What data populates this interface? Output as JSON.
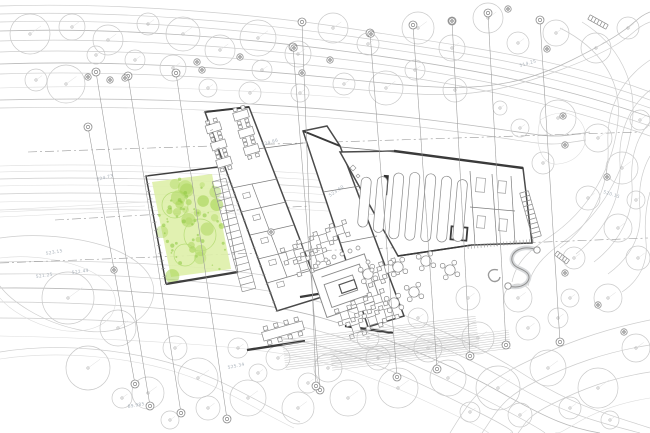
{
  "colors": {
    "background": "#ffffff",
    "contour": "#cdcdcd",
    "wall_dark": "#3f3f3f",
    "wall_medium": "#7d7d7d",
    "grid": "#989898",
    "tree": "#c9c9c9",
    "green_fill": "#def0a9",
    "green_blob": "#a3d24f",
    "label": "#9aa4ae",
    "furniture": "#8a8a8a"
  },
  "annotations": {
    "elevation_labels": [
      {
        "text": "524.73",
        "x": 97,
        "y": 181,
        "rot": -14
      },
      {
        "text": "523.15",
        "x": 46,
        "y": 255,
        "rot": -10
      },
      {
        "text": "521.25",
        "x": 36,
        "y": 278,
        "rot": -8
      },
      {
        "text": "522.49",
        "x": 72,
        "y": 274,
        "rot": -8
      },
      {
        "text": "525.34",
        "x": 228,
        "y": 369,
        "rot": -12
      },
      {
        "text": "89.985",
        "x": 128,
        "y": 408,
        "rot": -10
      },
      {
        "text": "524.86",
        "x": 262,
        "y": 146,
        "rot": -16
      },
      {
        "text": "523.60",
        "x": 330,
        "y": 197,
        "rot": -34
      },
      {
        "text": "514.25",
        "x": 520,
        "y": 67,
        "rot": -16
      },
      {
        "text": "520.15",
        "x": 603,
        "y": 193,
        "rot": 18
      }
    ]
  },
  "site": {
    "trees": [
      [
        30,
        34,
        20
      ],
      [
        72,
        27,
        13
      ],
      [
        108,
        40,
        15
      ],
      [
        66,
        84,
        19
      ],
      [
        36,
        80,
        11
      ],
      [
        148,
        24,
        11
      ],
      [
        183,
        34,
        17
      ],
      [
        173,
        68,
        13
      ],
      [
        220,
        50,
        15
      ],
      [
        258,
        38,
        18
      ],
      [
        298,
        54,
        13
      ],
      [
        333,
        28,
        15
      ],
      [
        368,
        44,
        11
      ],
      [
        418,
        28,
        16
      ],
      [
        452,
        48,
        13
      ],
      [
        488,
        18,
        15
      ],
      [
        518,
        43,
        11
      ],
      [
        556,
        33,
        13
      ],
      [
        596,
        48,
        15
      ],
      [
        628,
        28,
        11
      ],
      [
        250,
        93,
        11
      ],
      [
        208,
        88,
        9
      ],
      [
        300,
        93,
        9
      ],
      [
        344,
        84,
        11
      ],
      [
        386,
        88,
        17
      ],
      [
        415,
        70,
        10
      ],
      [
        455,
        90,
        12
      ],
      [
        262,
        70,
        10
      ],
      [
        135,
        60,
        10
      ],
      [
        96,
        55,
        9
      ],
      [
        558,
        118,
        18
      ],
      [
        598,
        138,
        14
      ],
      [
        622,
        168,
        16
      ],
      [
        588,
        198,
        12
      ],
      [
        618,
        228,
        14
      ],
      [
        574,
        258,
        11
      ],
      [
        638,
        258,
        12
      ],
      [
        608,
        298,
        14
      ],
      [
        570,
        298,
        9
      ],
      [
        520,
        128,
        9
      ],
      [
        543,
        163,
        11
      ],
      [
        500,
        108,
        7
      ],
      [
        640,
        120,
        10
      ],
      [
        636,
        200,
        9
      ],
      [
        68,
        298,
        26
      ],
      [
        118,
        328,
        18
      ],
      [
        88,
        368,
        22
      ],
      [
        148,
        393,
        16
      ],
      [
        198,
        378,
        20
      ],
      [
        248,
        398,
        18
      ],
      [
        298,
        408,
        16
      ],
      [
        348,
        398,
        18
      ],
      [
        398,
        388,
        20
      ],
      [
        448,
        378,
        18
      ],
      [
        498,
        388,
        22
      ],
      [
        548,
        368,
        18
      ],
      [
        598,
        388,
        20
      ],
      [
        636,
        348,
        14
      ],
      [
        278,
        358,
        12
      ],
      [
        328,
        368,
        14
      ],
      [
        378,
        358,
        12
      ],
      [
        428,
        348,
        14
      ],
      [
        478,
        338,
        16
      ],
      [
        528,
        328,
        12
      ],
      [
        238,
        348,
        10
      ],
      [
        175,
        348,
        12
      ],
      [
        518,
        298,
        14
      ],
      [
        558,
        318,
        10
      ],
      [
        468,
        298,
        12
      ],
      [
        418,
        318,
        10
      ],
      [
        368,
        338,
        11
      ],
      [
        308,
        383,
        10
      ],
      [
        258,
        373,
        9
      ],
      [
        208,
        408,
        12
      ],
      [
        122,
        398,
        10
      ],
      [
        170,
        420,
        9
      ],
      [
        520,
        415,
        12
      ],
      [
        470,
        412,
        10
      ],
      [
        570,
        408,
        11
      ],
      [
        610,
        420,
        9
      ]
    ],
    "tree_tags": [
      [
        88,
        77
      ],
      [
        110,
        80
      ],
      [
        125,
        78
      ],
      [
        197,
        62
      ],
      [
        202,
        70
      ],
      [
        294,
        48
      ],
      [
        302,
        73
      ],
      [
        371,
        34
      ],
      [
        452,
        21
      ],
      [
        508,
        9
      ],
      [
        547,
        49
      ],
      [
        563,
        116
      ],
      [
        565,
        145
      ],
      [
        607,
        177
      ],
      [
        271,
        232
      ],
      [
        114,
        270
      ],
      [
        565,
        273
      ],
      [
        598,
        305
      ],
      [
        624,
        332
      ],
      [
        330,
        60
      ],
      [
        240,
        57
      ]
    ],
    "grid_lines": [
      [
        88,
        127,
        135,
        384
      ],
      [
        96,
        72,
        150,
        406
      ],
      [
        128,
        76,
        181,
        413
      ],
      [
        176,
        73,
        227,
        419
      ],
      [
        293,
        47,
        320,
        390
      ],
      [
        302,
        22,
        316,
        386
      ],
      [
        370,
        33,
        397,
        377
      ],
      [
        413,
        25,
        437,
        369
      ],
      [
        452,
        21,
        470,
        356
      ],
      [
        488,
        13,
        506,
        345
      ],
      [
        540,
        20,
        560,
        342
      ]
    ],
    "stairs": [
      {
        "x1": 219,
        "y1": 180,
        "x2": 249,
        "y2": 290,
        "w": 14,
        "n": 17
      },
      {
        "x1": 524,
        "y1": 192,
        "x2": 537,
        "y2": 237,
        "w": 9,
        "n": 10
      },
      {
        "x1": 589,
        "y1": 17,
        "x2": 607,
        "y2": 27,
        "w": 5,
        "n": 6
      },
      {
        "x1": 556,
        "y1": 253,
        "x2": 568,
        "y2": 262,
        "w": 5,
        "n": 5
      }
    ],
    "hatches": [
      {
        "x": 282,
        "y": 340,
        "rot": -7,
        "len": 195,
        "n": 14,
        "gap": 2.3
      },
      {
        "x": 330,
        "y": 352,
        "rot": -7,
        "len": 180,
        "n": 9,
        "gap": 2.3
      }
    ],
    "ticked_walls": [
      {
        "x1": 468,
        "y1": 247,
        "x2": 533,
        "y2": 241,
        "n": 20,
        "len": 4
      },
      {
        "x1": 146,
        "y1": 176,
        "x2": 166,
        "y2": 284,
        "n": 14,
        "len": 4
      },
      {
        "x1": 205,
        "y1": 112,
        "x2": 277,
        "y2": 311,
        "n": 22,
        "len": 3
      }
    ]
  },
  "green_area": {
    "poly": "152,182 212,174 231,269 171,277",
    "blob_count": 26,
    "dot_count": 42
  },
  "furniture": {
    "classroom_rot": -17,
    "classroom_center": [
      235,
      140
    ],
    "classroom_tables": [
      [
        218,
        122
      ],
      [
        218,
        140
      ],
      [
        218,
        158
      ],
      [
        248,
        118
      ],
      [
        248,
        136
      ],
      [
        248,
        154
      ]
    ],
    "long_tables": [
      [
        364,
        182,
        50
      ],
      [
        380,
        180,
        56
      ],
      [
        396,
        175,
        66
      ],
      [
        412,
        173,
        68
      ],
      [
        428,
        173,
        68
      ],
      [
        444,
        174,
        66
      ],
      [
        460,
        176,
        62
      ]
    ],
    "long_rot": 5,
    "long_center": [
      420,
      210
    ],
    "square_rot": -17,
    "square_center": [
      345,
      285
    ],
    "square_tables": [
      [
        302,
        240
      ],
      [
        320,
        237
      ],
      [
        338,
        234
      ],
      [
        356,
        231
      ],
      [
        311,
        255
      ],
      [
        329,
        252
      ],
      [
        336,
        314
      ],
      [
        354,
        311
      ],
      [
        372,
        308
      ],
      [
        343,
        330
      ],
      [
        361,
        327
      ],
      [
        379,
        324
      ],
      [
        376,
        286
      ],
      [
        392,
        282
      ]
    ],
    "round_tables": [
      [
        368,
        274
      ],
      [
        398,
        267
      ],
      [
        426,
        261
      ],
      [
        450,
        270
      ],
      [
        414,
        292
      ],
      [
        394,
        303
      ]
    ],
    "stools": [
      [
        318,
        263
      ],
      [
        326,
        260
      ],
      [
        334,
        257
      ],
      [
        342,
        254
      ],
      [
        350,
        251
      ],
      [
        358,
        248
      ],
      [
        368,
        262
      ],
      [
        372,
        270
      ]
    ],
    "meeting_table": {
      "x": 283,
      "y": 331,
      "rot": -16,
      "w": 42,
      "h": 9
    }
  }
}
